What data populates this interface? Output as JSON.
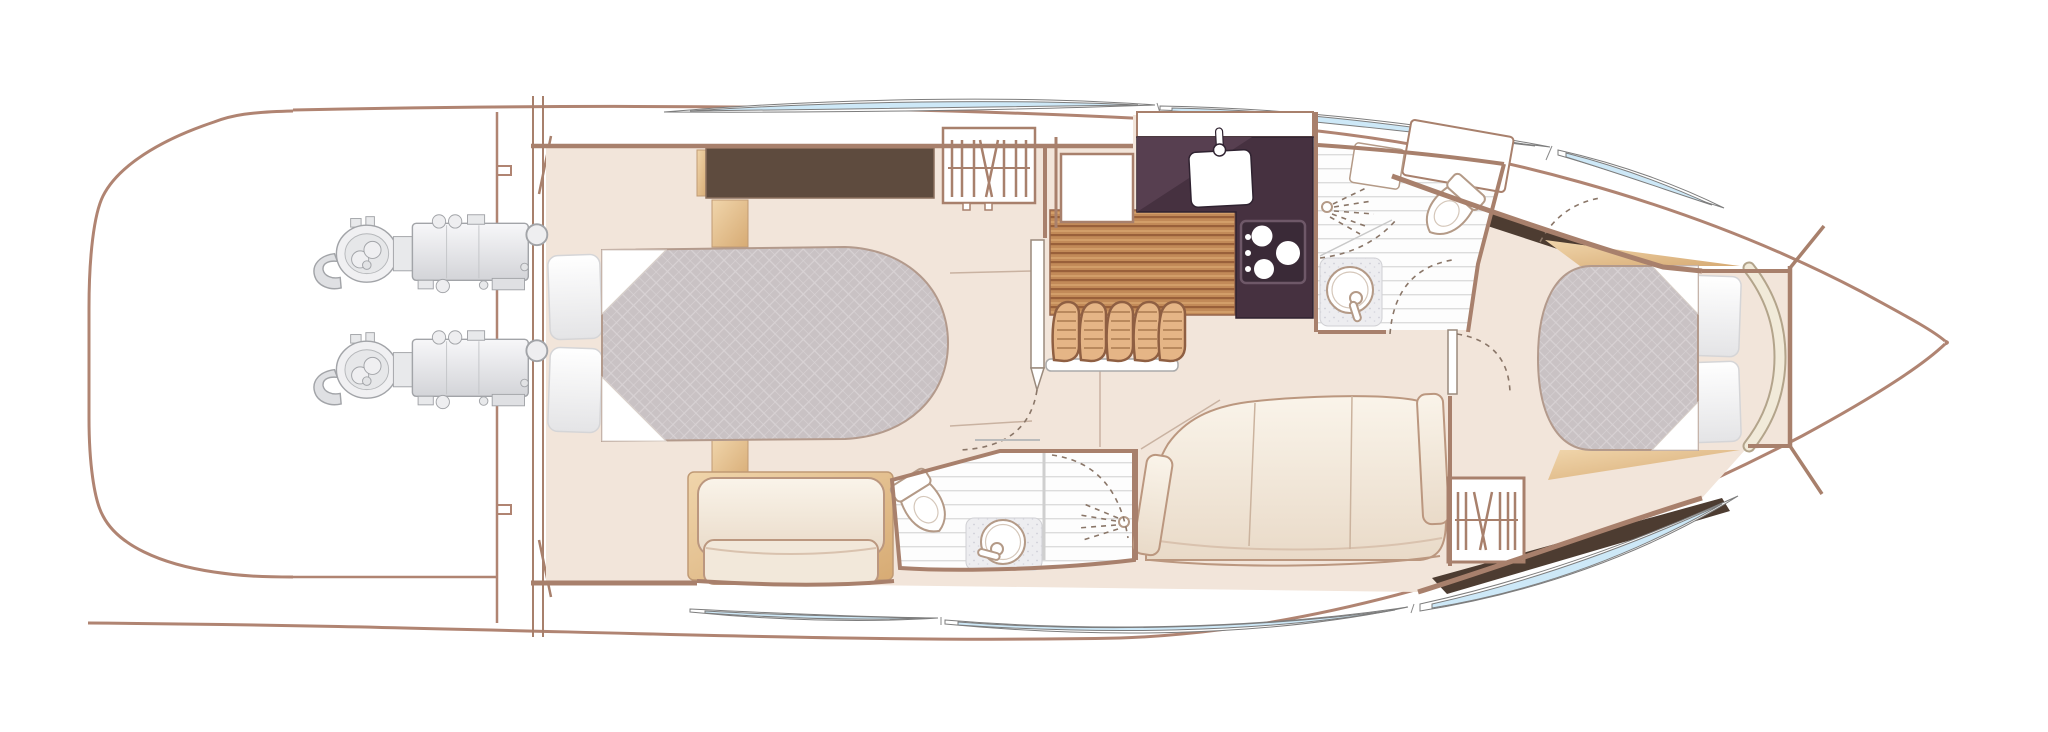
{
  "figure": {
    "kind": "yacht-lower-deck-floor-plan",
    "orientation": "bow-right",
    "visible_text": "",
    "description": "Top-down interior arrangement plan of a motor yacht lower deck"
  },
  "canvas": {
    "width": 2048,
    "height": 732,
    "background": "#ffffff"
  },
  "colors": {
    "hull_outline": "#b08472",
    "interior_wall": "#a8806c",
    "floor_cream": "#f2e5da",
    "headboard_dark_brown": "#5e4b3e",
    "galley_counter_aubergine": "#463140",
    "teak_sole": "#c28a58",
    "stair_tread_wood": "#e5b586",
    "mattress_gray": "#c9c2c4",
    "upholstery_cream": "#f6eee3",
    "table_tan": "#e5c496",
    "window_glass_blue": "#cde8f7",
    "engine_gray": "#e4e5e8",
    "bath_floor_white": "#fdfdfd"
  },
  "areas": [
    {
      "id": "swim-platform",
      "label": "Swim platform and transom"
    },
    {
      "id": "engine-room",
      "label": "Engine room with twin engines"
    },
    {
      "id": "midship-cabin",
      "label": "Midship master cabin with double berth, wardrobe and sofa"
    },
    {
      "id": "midship-bathroom",
      "label": "Midship en-suite bathroom with toilet, basin and shower"
    },
    {
      "id": "companionway",
      "label": "Companionway stairs with teak treads and wood sole"
    },
    {
      "id": "galley",
      "label": "Galley with sink and three-burner hob"
    },
    {
      "id": "day-head",
      "label": "Day head bathroom with toilet, basin and shower"
    },
    {
      "id": "salon",
      "label": "Salon settee with occasional table"
    },
    {
      "id": "forward-cabin",
      "label": "Forward guest cabin with double berth and hanging locker"
    },
    {
      "id": "bow",
      "label": "Bow and forepeak locker"
    }
  ],
  "equipment": {
    "engines": 2,
    "berths": 2,
    "bathrooms": 2,
    "hanging_lockers": 2,
    "hob_burners": 3,
    "stair_treads": 5,
    "sofas": 2
  }
}
